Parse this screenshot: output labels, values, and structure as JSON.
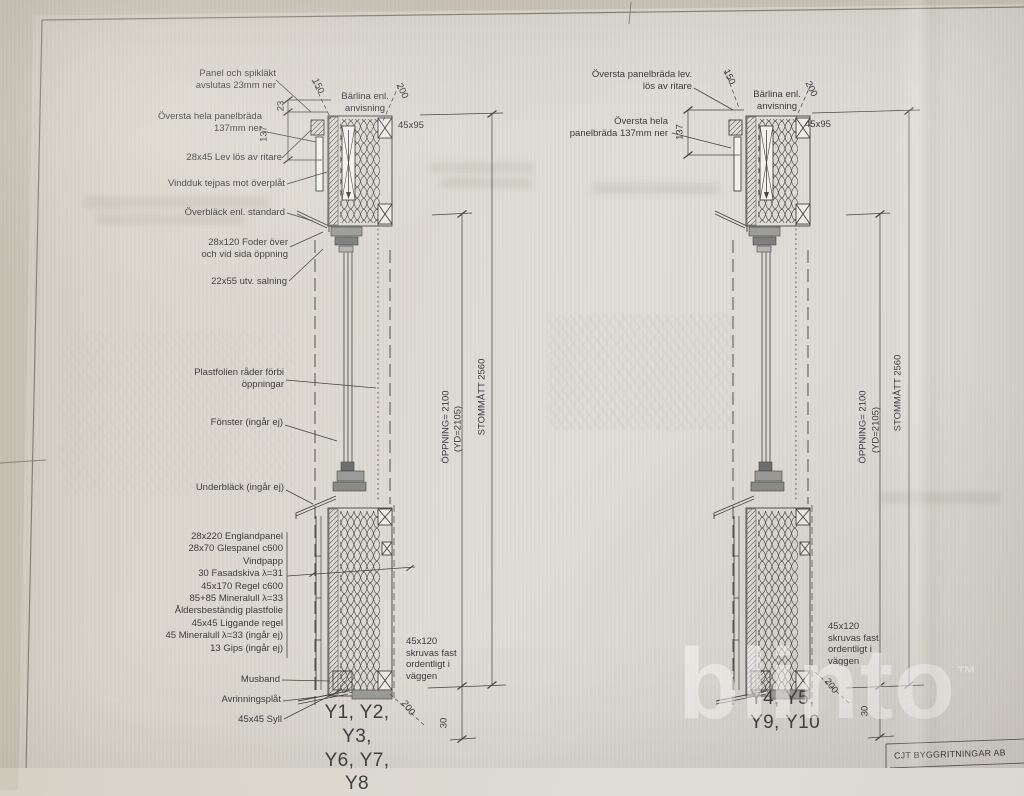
{
  "watermark": {
    "text": "blinto",
    "tm": "™"
  },
  "title_block": {
    "company": "CJT BYGGRITNINGAR AB"
  },
  "left_detail": {
    "callouts": {
      "panel_spiklakt": "Panel och spikläkt\navslutas 23mm ner",
      "oversta_hela": "Översta hela panelbräda\n137mm ner",
      "lev_los": "28x45 Lev lös av ritare",
      "vindduk": "Vindduk tejpas mot överplåt",
      "overblack": "Överbläck enl. standard",
      "foder": "28x120 Foder över\noch vid sida öppning",
      "salning": "22x55 utv. salning",
      "plastfolie": "Plastfolien råder förbi\nöppningar",
      "fonster": "Fönster (ingår ej)",
      "underblack": "Underbläck (ingår ej)",
      "barlina": "Bärlina enl.\nanvisning",
      "beam_size": "45x95",
      "skruvas": "45x120\nskruvas fast\nordentligt i\nväggen",
      "musband": "Musband",
      "avrinningsplat": "Avrinningsplåt",
      "syll": "45x45 Syll",
      "windows": "Y1, Y2, Y3,\nY6, Y7, Y8"
    },
    "layers": [
      "28x220 Englandpanel",
      "28x70 Glespanel c600",
      "Vindpapp",
      "30 Fasadskiva λ=31",
      "45x170 Regel c600",
      "85+85 Mineralull λ=33",
      "Åldersbeständig plastfolie",
      "45x45 Liggande regel",
      "45 Mineralull λ=33 (ingår ej)",
      "13 Gips (ingår ej)"
    ],
    "dims": {
      "d23": "23",
      "d137": "137",
      "d150": "150",
      "d200_top": "200",
      "opening": "ÖPPNING= 2100",
      "yd": "(YD=2105)",
      "stomm": "STOMMÅTT 2560",
      "d200_bottom": "200",
      "d30": "30"
    }
  },
  "right_detail": {
    "callouts": {
      "oversta_panelbrada": "Översta panelbräda lev.\nlös av ritare",
      "barlina": "Bärlina enl.\nanvisning",
      "beam_size": "45x95",
      "oversta_hela": "Översta hela\npanelbräda 137mm ner",
      "skruvas": "45x120\nskruvas fast\nordentligt i\nväggen",
      "windows": "Y4, Y5,\nY9, Y10"
    },
    "dims": {
      "d137": "137",
      "d150": "150",
      "d200_top": "200",
      "opening": "ÖPPNING= 2100",
      "yd": "(YD=2105)",
      "stomm": "STOMMÅTT 2560",
      "d200_bottom": "200",
      "d30": "30"
    }
  }
}
